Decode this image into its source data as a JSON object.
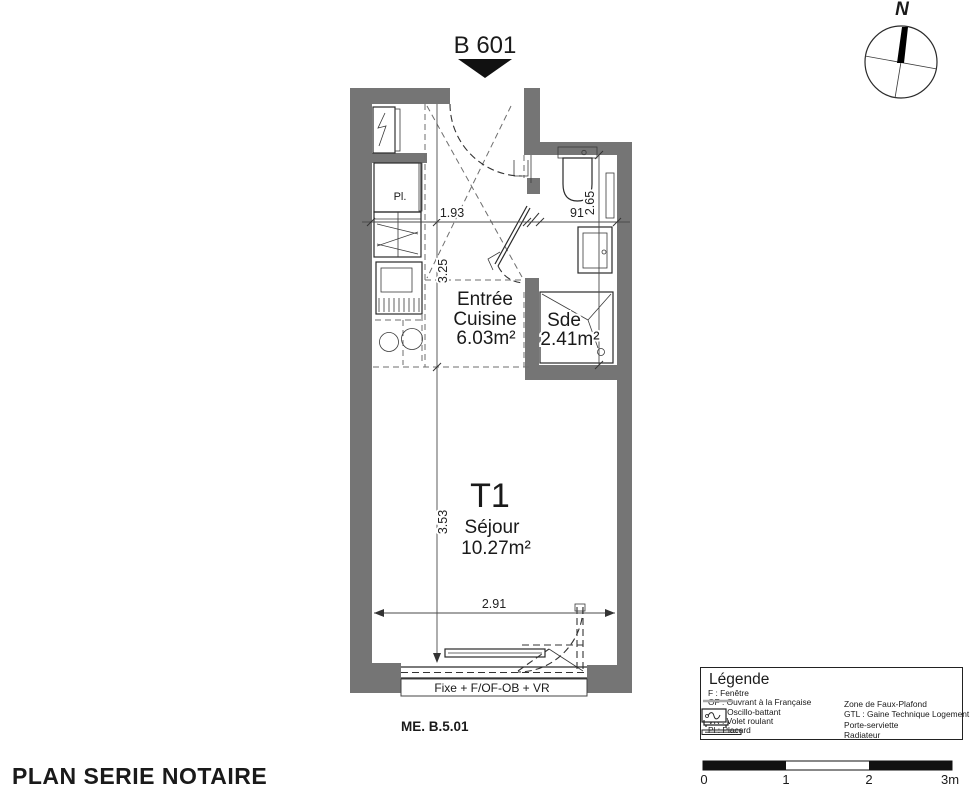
{
  "page": {
    "title_unit": "B 601",
    "footer": "PLAN SERIE NOTAIRE",
    "ref_code": "ME. B.5.01"
  },
  "compass": {
    "north": "N"
  },
  "rooms": {
    "entree": {
      "line1": "Entrée",
      "line2": "Cuisine",
      "area": "6.03m²"
    },
    "sde": {
      "name": "Sde",
      "area": "2.41m²"
    },
    "sejour": {
      "type": "T1",
      "name": "Séjour",
      "area": "10.27m²"
    },
    "closet": "Pl."
  },
  "dimensions": {
    "entree_w": "1.93",
    "entree_h": "3.25",
    "sde_w": "91",
    "sde_h": "2.65",
    "sejour_h": "3.53",
    "sejour_w": "2.91"
  },
  "window": {
    "label": "Fixe + F/OF-OB + VR"
  },
  "legend": {
    "title": "Légende",
    "abbrev": [
      "F : Fenêtre",
      "OF : Ouvrant à la Française",
      "OB : Oscillo-battant",
      "VR : Volet roulant",
      "Pl : Placard"
    ],
    "symbols": [
      {
        "icon": "faux-plafond-line-icon",
        "label": "Zone de Faux-Plafond"
      },
      {
        "icon": "gtl-box-icon",
        "label": "GTL : Gaine Technique Logement"
      },
      {
        "icon": "towel-rail-icon",
        "label": "Porte-serviette"
      },
      {
        "icon": "radiator-icon",
        "label": "Radiateur"
      }
    ]
  },
  "scalebar": {
    "t0": "0",
    "t1": "1",
    "t2": "2",
    "t3": "3m"
  },
  "colors": {
    "wall": "#757575",
    "dim": "#4a4a4a",
    "dash": "#6e6e6e"
  }
}
